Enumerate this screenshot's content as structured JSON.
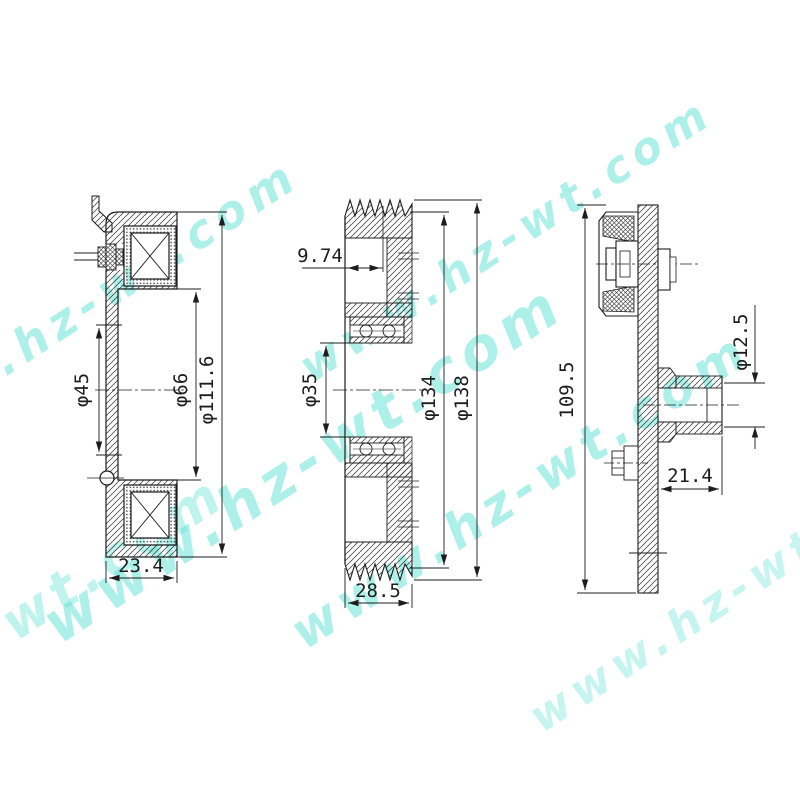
{
  "drawing": {
    "watermark": {
      "text": "www.hz-wt.com",
      "color": "#5ee2d5"
    },
    "views": {
      "coil": {
        "dims": {
          "bore": "φ45",
          "inner": "φ66",
          "outer": "φ111.6",
          "width": "23.4"
        }
      },
      "pulley": {
        "dims": {
          "groove_offset": "9.74",
          "bore": "φ35",
          "root_dia": "φ134",
          "outer_dia": "φ138",
          "width": "28.5"
        }
      },
      "hub": {
        "dims": {
          "overall": "109.5",
          "shaft_bore": "φ12.5",
          "hub_depth": "21.4"
        }
      }
    }
  }
}
